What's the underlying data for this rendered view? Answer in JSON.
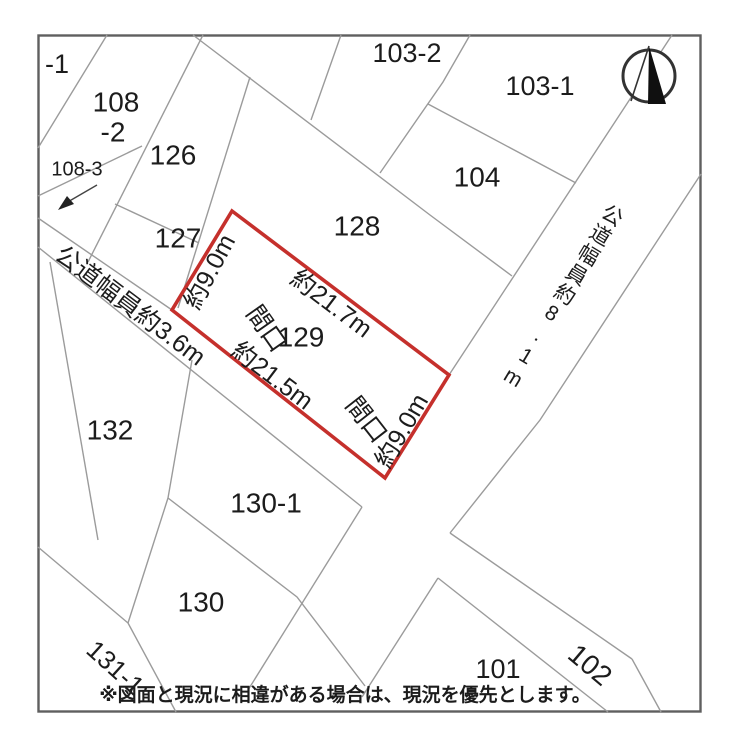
{
  "map": {
    "parcels": {
      "p108_1_suffix": "-1",
      "p108_2_line1": "108",
      "p108_2_line2": "-2",
      "p108_3": "108-3",
      "p126": "126",
      "p127": "127",
      "p128": "128",
      "p103_2": "103-2",
      "p103_1": "103-1",
      "p104": "104",
      "p132": "132",
      "p130_1": "130-1",
      "p130": "130",
      "p131_1": "131-1",
      "p101": "101",
      "p102": "102"
    },
    "subject_parcel": {
      "number": "129",
      "side_left": "約9.0m",
      "side_top": "約21.7m",
      "frontage_label_bottom": "間口",
      "side_bottom": "約21.5m",
      "frontage_label_right": "間口",
      "side_right": "約9.0m"
    },
    "roads": {
      "road_narrow": "公道幅員約3.6m",
      "road_wide": "公道幅員約8.1m"
    },
    "note": "※図面と現況に相違がある場合は、現況を優先とします。",
    "compass": "north-arrow"
  },
  "colors": {
    "subject_outline": "#c5302c",
    "boundary_line": "#9b9b9b",
    "border": "#5f5f5f",
    "text": "#1c1c1c"
  }
}
